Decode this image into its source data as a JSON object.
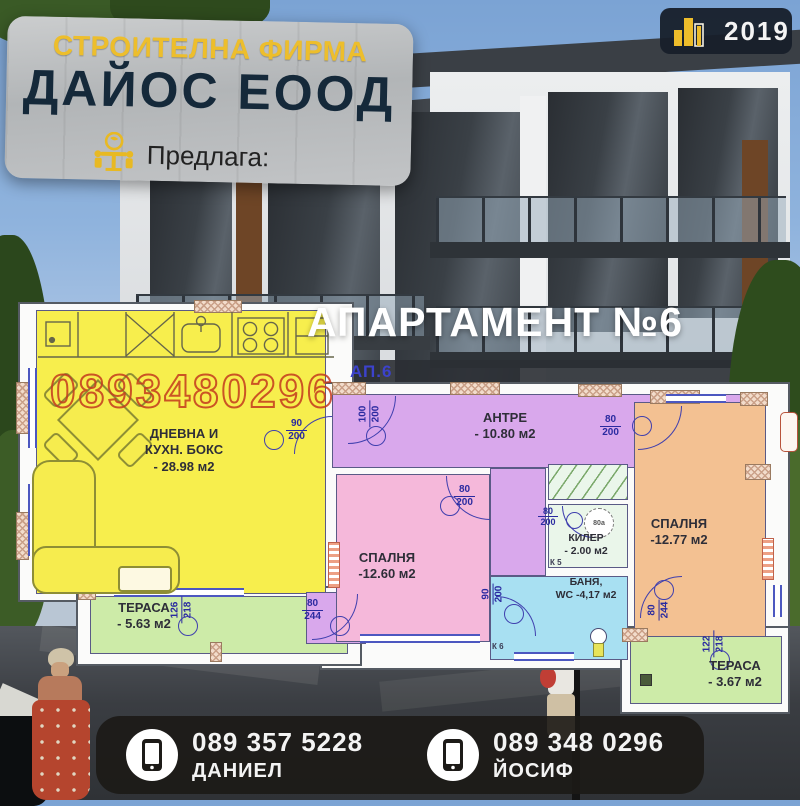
{
  "banner": {
    "tagline": "СТРОИТЕЛНА ФИРМА",
    "company": "ДАЙОС ЕООД",
    "offers": "Предлага:"
  },
  "year_badge": {
    "year": "2019"
  },
  "title": {
    "main": "АПАРТАМЕНТ №6",
    "code": "АП.6"
  },
  "watermark": "0893480296",
  "colors": {
    "accent_yellow": "#eebd2b",
    "banner_navy": "#15293a",
    "watermark_red": "#c43a1e",
    "plan_line_blue": "#3f3fae"
  },
  "plan": {
    "rooms": {
      "living": {
        "line1": "ДНЕВНА И",
        "line2": "КУХН. БОКС",
        "area": "- 28.98 м2",
        "fill": "#f7ee4d"
      },
      "terrace_left": {
        "name": "ТЕРАСА",
        "area": "- 5.63 м2",
        "fill": "#cdeba8"
      },
      "hall": {
        "name": "АНТРЕ",
        "area": "- 10.80 м2",
        "fill": "#d9a8ec"
      },
      "bedroom_1": {
        "name": "СПАЛНЯ",
        "area": "-12.60 м2",
        "fill": "#f5b8da"
      },
      "closet": {
        "name": "КИЛЕР",
        "area": "- 2.00 м2",
        "fill": "#eaf6ea"
      },
      "bath": {
        "line1": "БАНЯ,",
        "line2": "WC -4,17 м2",
        "fill": "#a8e0f2"
      },
      "bedroom_2": {
        "name": "СПАЛНЯ",
        "area": "-12.77 м2",
        "fill": "#f3c192"
      },
      "terrace_right": {
        "name": "ТЕРАСА",
        "area": "- 3.67 м2",
        "fill": "#cdeba8"
      }
    },
    "dims": {
      "entrance": [
        "100",
        "200"
      ],
      "living_door": [
        "90",
        "200"
      ],
      "bedroom1_door": [
        "80",
        "200"
      ],
      "bedroom2_door": [
        "80",
        "200"
      ],
      "closet_door": [
        "80",
        "200"
      ],
      "bath_door": [
        "90",
        "200"
      ],
      "vestibule_door": [
        "80",
        "244"
      ],
      "terrace2_door": [
        "80",
        "244"
      ],
      "terrace1_window": [
        "126",
        "218"
      ],
      "terrace2_window": [
        "122",
        "218"
      ]
    },
    "notes": {
      "k5": "К 5",
      "k6": "К 6",
      "boiler": "80а"
    }
  },
  "footer": {
    "contacts": [
      {
        "phone": "089 357 5228",
        "name": "ДАНИЕЛ"
      },
      {
        "phone": "089 348 0296",
        "name": "ЙОСИФ"
      }
    ]
  }
}
